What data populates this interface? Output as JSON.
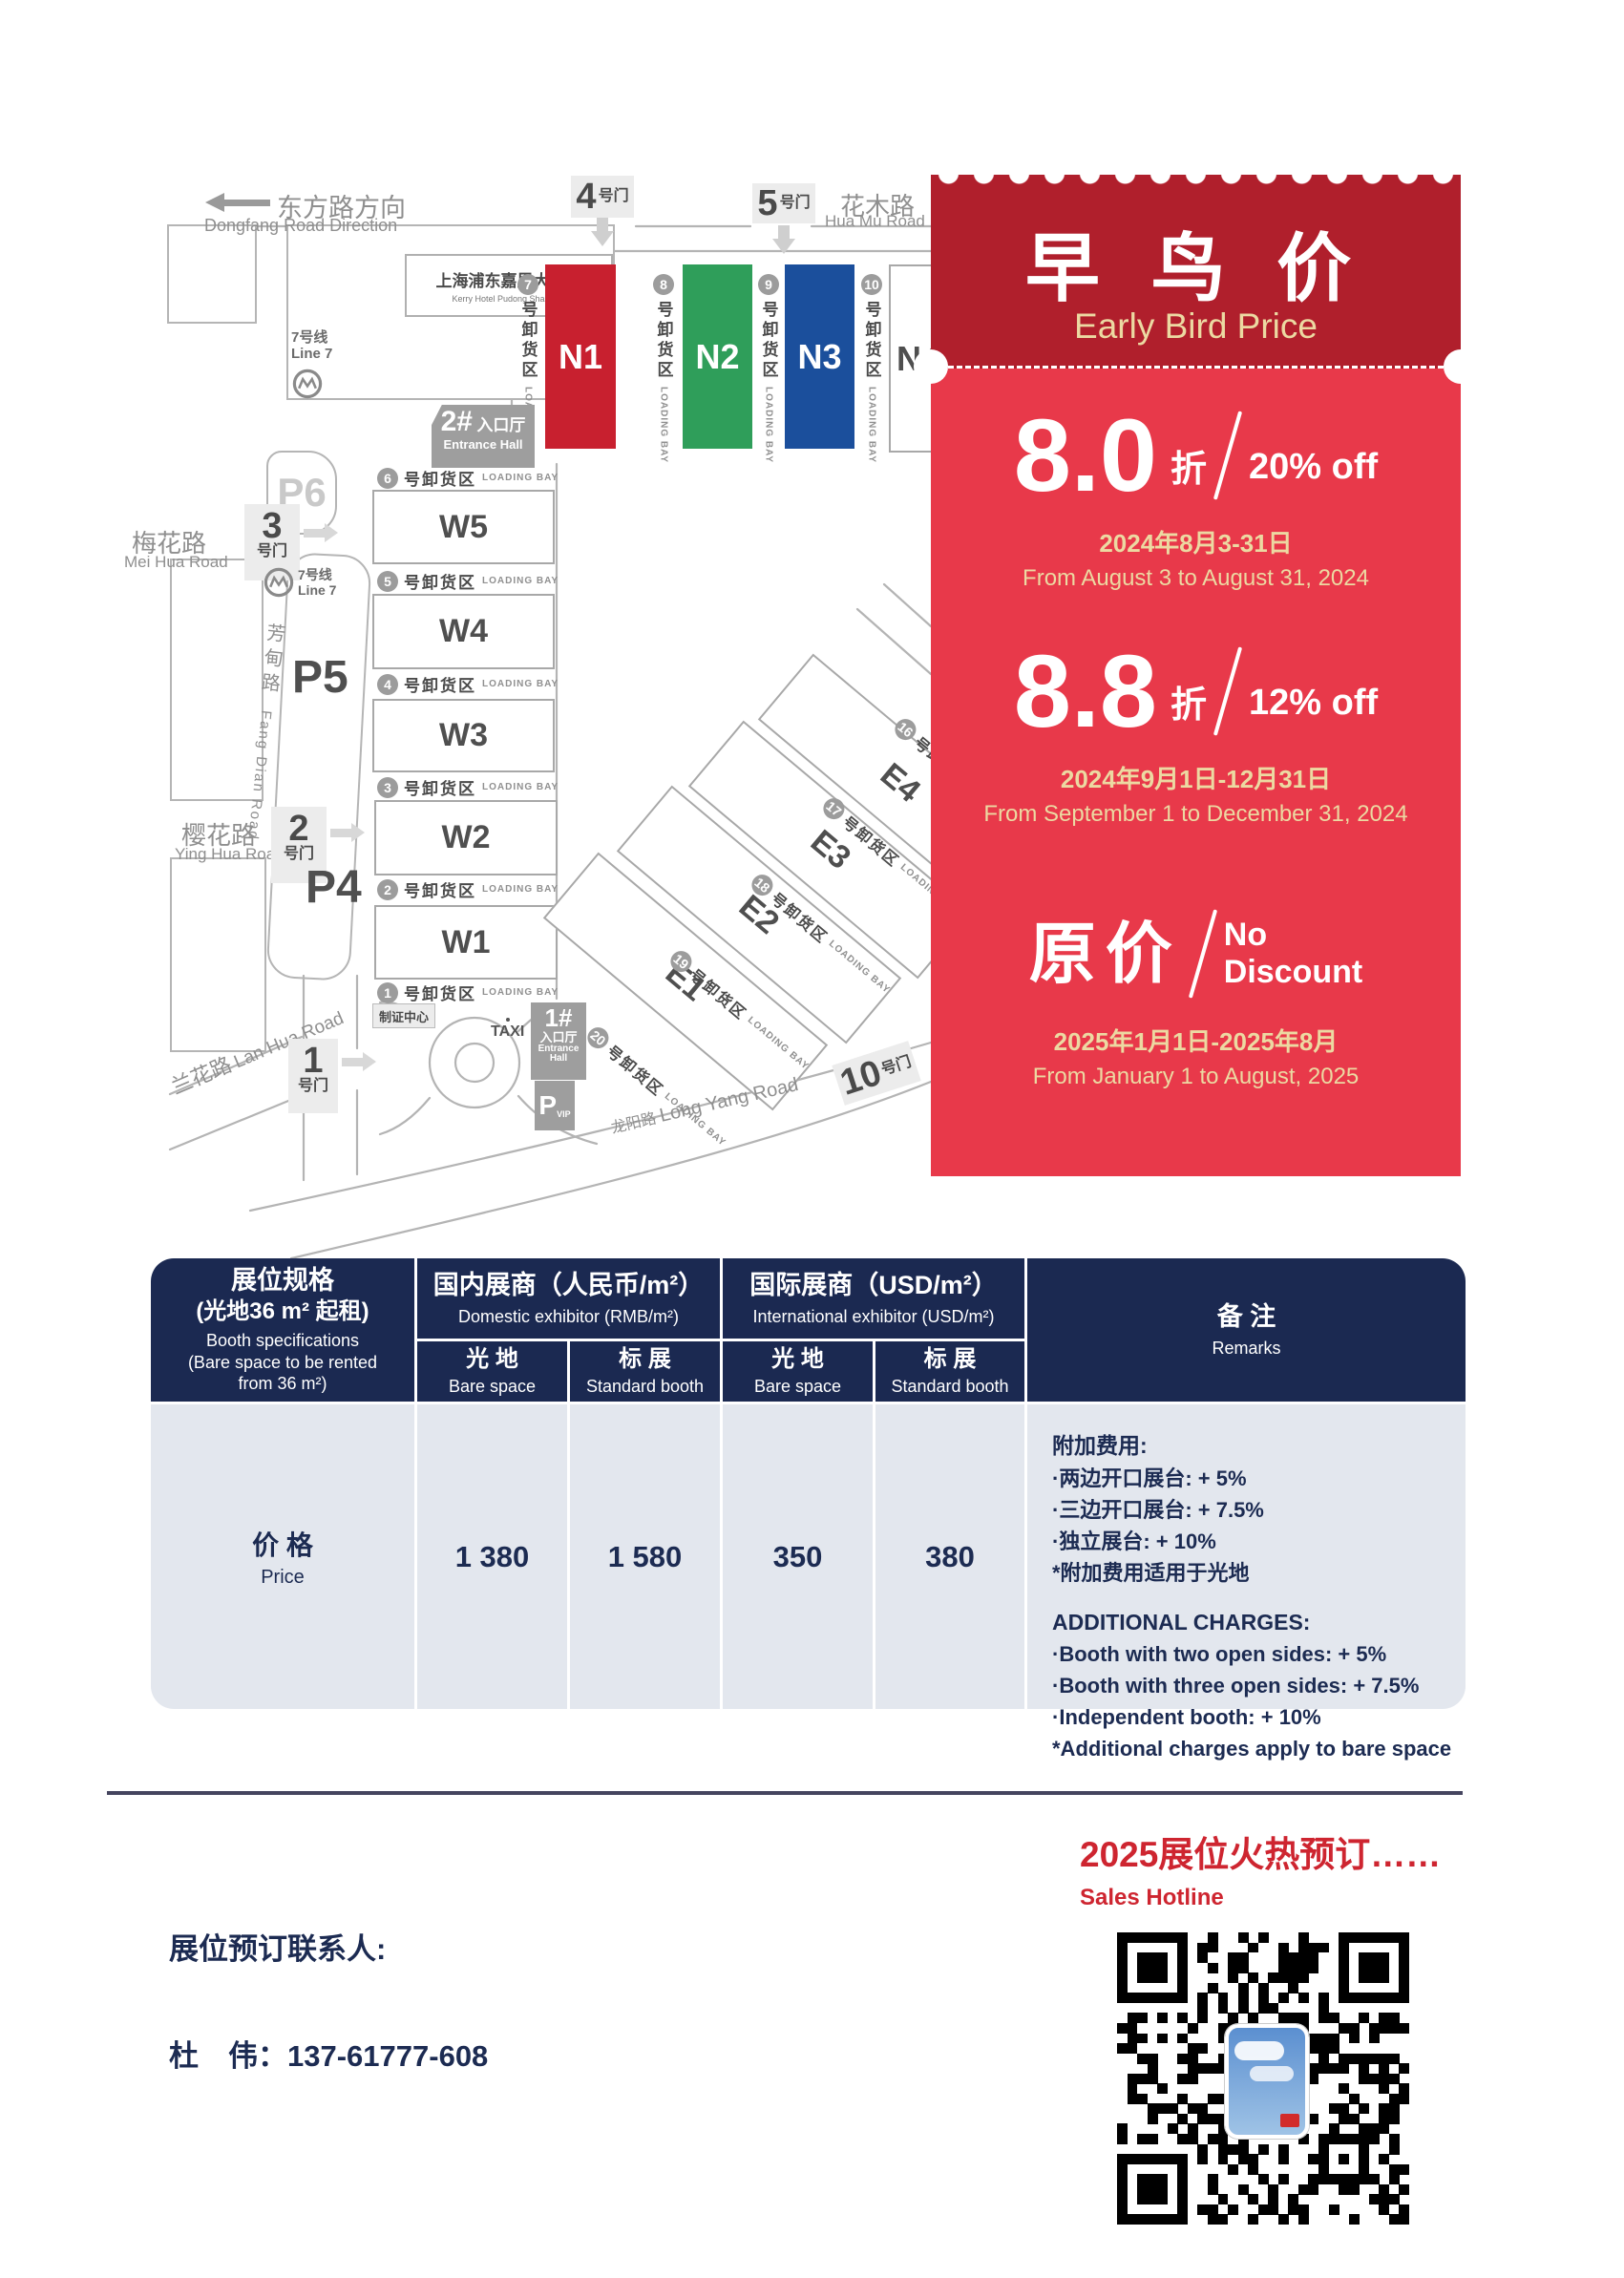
{
  "map": {
    "direction_cn": "东方路方向",
    "direction_en": "Dongfang Road Direction",
    "hotel_cn": "上海浦东嘉里大酒店",
    "hotel_en": "Kerry Hotel Pudong Shanghai",
    "metro_cn": "7号线",
    "metro_en": "Line 7",
    "roads": {
      "huamu_cn": "花木路",
      "huamu_en": "Hua Mu Road",
      "meihua_cn": "梅花路",
      "meihua_en": "Mei Hua Road",
      "fangdian_cn": "芳甸路",
      "fangdian_en": "Fang Dian Road",
      "yinghua_cn": "樱花路",
      "yinghua_en": "Ying Hua Road",
      "lanhua_cn": "兰花路",
      "lanhua_en": "Lan Hua Road",
      "longyang_cn": "龙阳路",
      "longyang_en": "Long Yang Road"
    },
    "gates": {
      "g1": "1",
      "g2": "2",
      "g3": "3",
      "g4": "4",
      "g5": "5",
      "g10": "10",
      "suffix": "号门"
    },
    "parking": {
      "p4": "P4",
      "p5": "P5",
      "p6": "P6",
      "vip_p": "P",
      "vip": "VIP"
    },
    "entrance1_num": "1#",
    "entrance2_num": "2#",
    "entrance_cn": "入口厅",
    "entrance_en": "Entrance Hall",
    "badge_center": "制证中心",
    "taxi": "TAXI",
    "bay_cn": "号卸货区",
    "bay_en": "LOADING BAY",
    "halls_n": [
      "N1",
      "N2",
      "N3",
      "N4"
    ],
    "halls_w": [
      "W5",
      "W4",
      "W3",
      "W2",
      "W1"
    ],
    "halls_e": [
      "E1",
      "E2",
      "E3",
      "E4"
    ],
    "bays_n": [
      "7",
      "8",
      "9",
      "10"
    ],
    "bays_w": [
      "6",
      "5",
      "4",
      "3",
      "2",
      "1"
    ],
    "bays_e": [
      "16",
      "17",
      "18",
      "19",
      "20"
    ],
    "hall_colors": {
      "n1": "#c8202f",
      "n2": "#2f9e5a",
      "n3": "#1b4f9c",
      "n4": "#ffffff"
    }
  },
  "promo": {
    "title_cn": "早 鸟 价",
    "title_en": "Early Bird Price",
    "colors": {
      "header": "#b01f2c",
      "body": "#e8394a",
      "gold": "#ecd9a2"
    },
    "tiers": [
      {
        "big": "8.0",
        "unit": "折",
        "pct": "20% off",
        "date_cn": "2024年8月3-31日",
        "date_en": "From August 3 to August 31, 2024"
      },
      {
        "big": "8.8",
        "unit": "折",
        "pct": "12% off",
        "date_cn": "2024年9月1日-12月31日",
        "date_en": "From September 1 to December 31, 2024"
      },
      {
        "big": "原价",
        "pct_line1": "No",
        "pct_line2": "Discount",
        "date_cn": "2025年1月1日-2025年8月",
        "date_en": "From January 1 to August, 2025"
      }
    ]
  },
  "table": {
    "spec_cn1": "展位规格",
    "spec_cn2": "(光地36 m² 起租)",
    "spec_en1": "Booth specifications",
    "spec_en2": "(Bare space to be rented from 36 m²)",
    "domestic_cn": "国内展商（人民币/m²）",
    "domestic_en": "Domestic exhibitor (RMB/m²)",
    "intl_cn": "国际展商（USD/m²）",
    "intl_en": "International exhibitor (USD/m²)",
    "bare_cn": "光 地",
    "bare_en": "Bare space",
    "std_cn": "标 展",
    "std_en": "Standard booth",
    "remarks_cn": "备 注",
    "remarks_en": "Remarks",
    "price_cn": "价 格",
    "price_en": "Price",
    "values": [
      "1 380",
      "1 580",
      "350",
      "380"
    ],
    "remarks": {
      "cn_title": "附加费用:",
      "cn_items": [
        "·两边开口展台: + 5%",
        "·三边开口展台: + 7.5%",
        "·独立展台: + 10%",
        "*附加费用适用于光地"
      ],
      "en_title": "ADDITIONAL CHARGES:",
      "en_items": [
        "·Booth with two open sides: + 5%",
        "·Booth with three open sides: + 7.5%",
        "·Independent booth: + 10%",
        "*Additional charges apply to bare space"
      ]
    }
  },
  "footer": {
    "hot_cn": "2025展位火热预订……",
    "hot_en": "Sales Hotline",
    "contact_label": "展位预订联系人:",
    "contact_phone": "杜　伟：137-61777-608"
  }
}
